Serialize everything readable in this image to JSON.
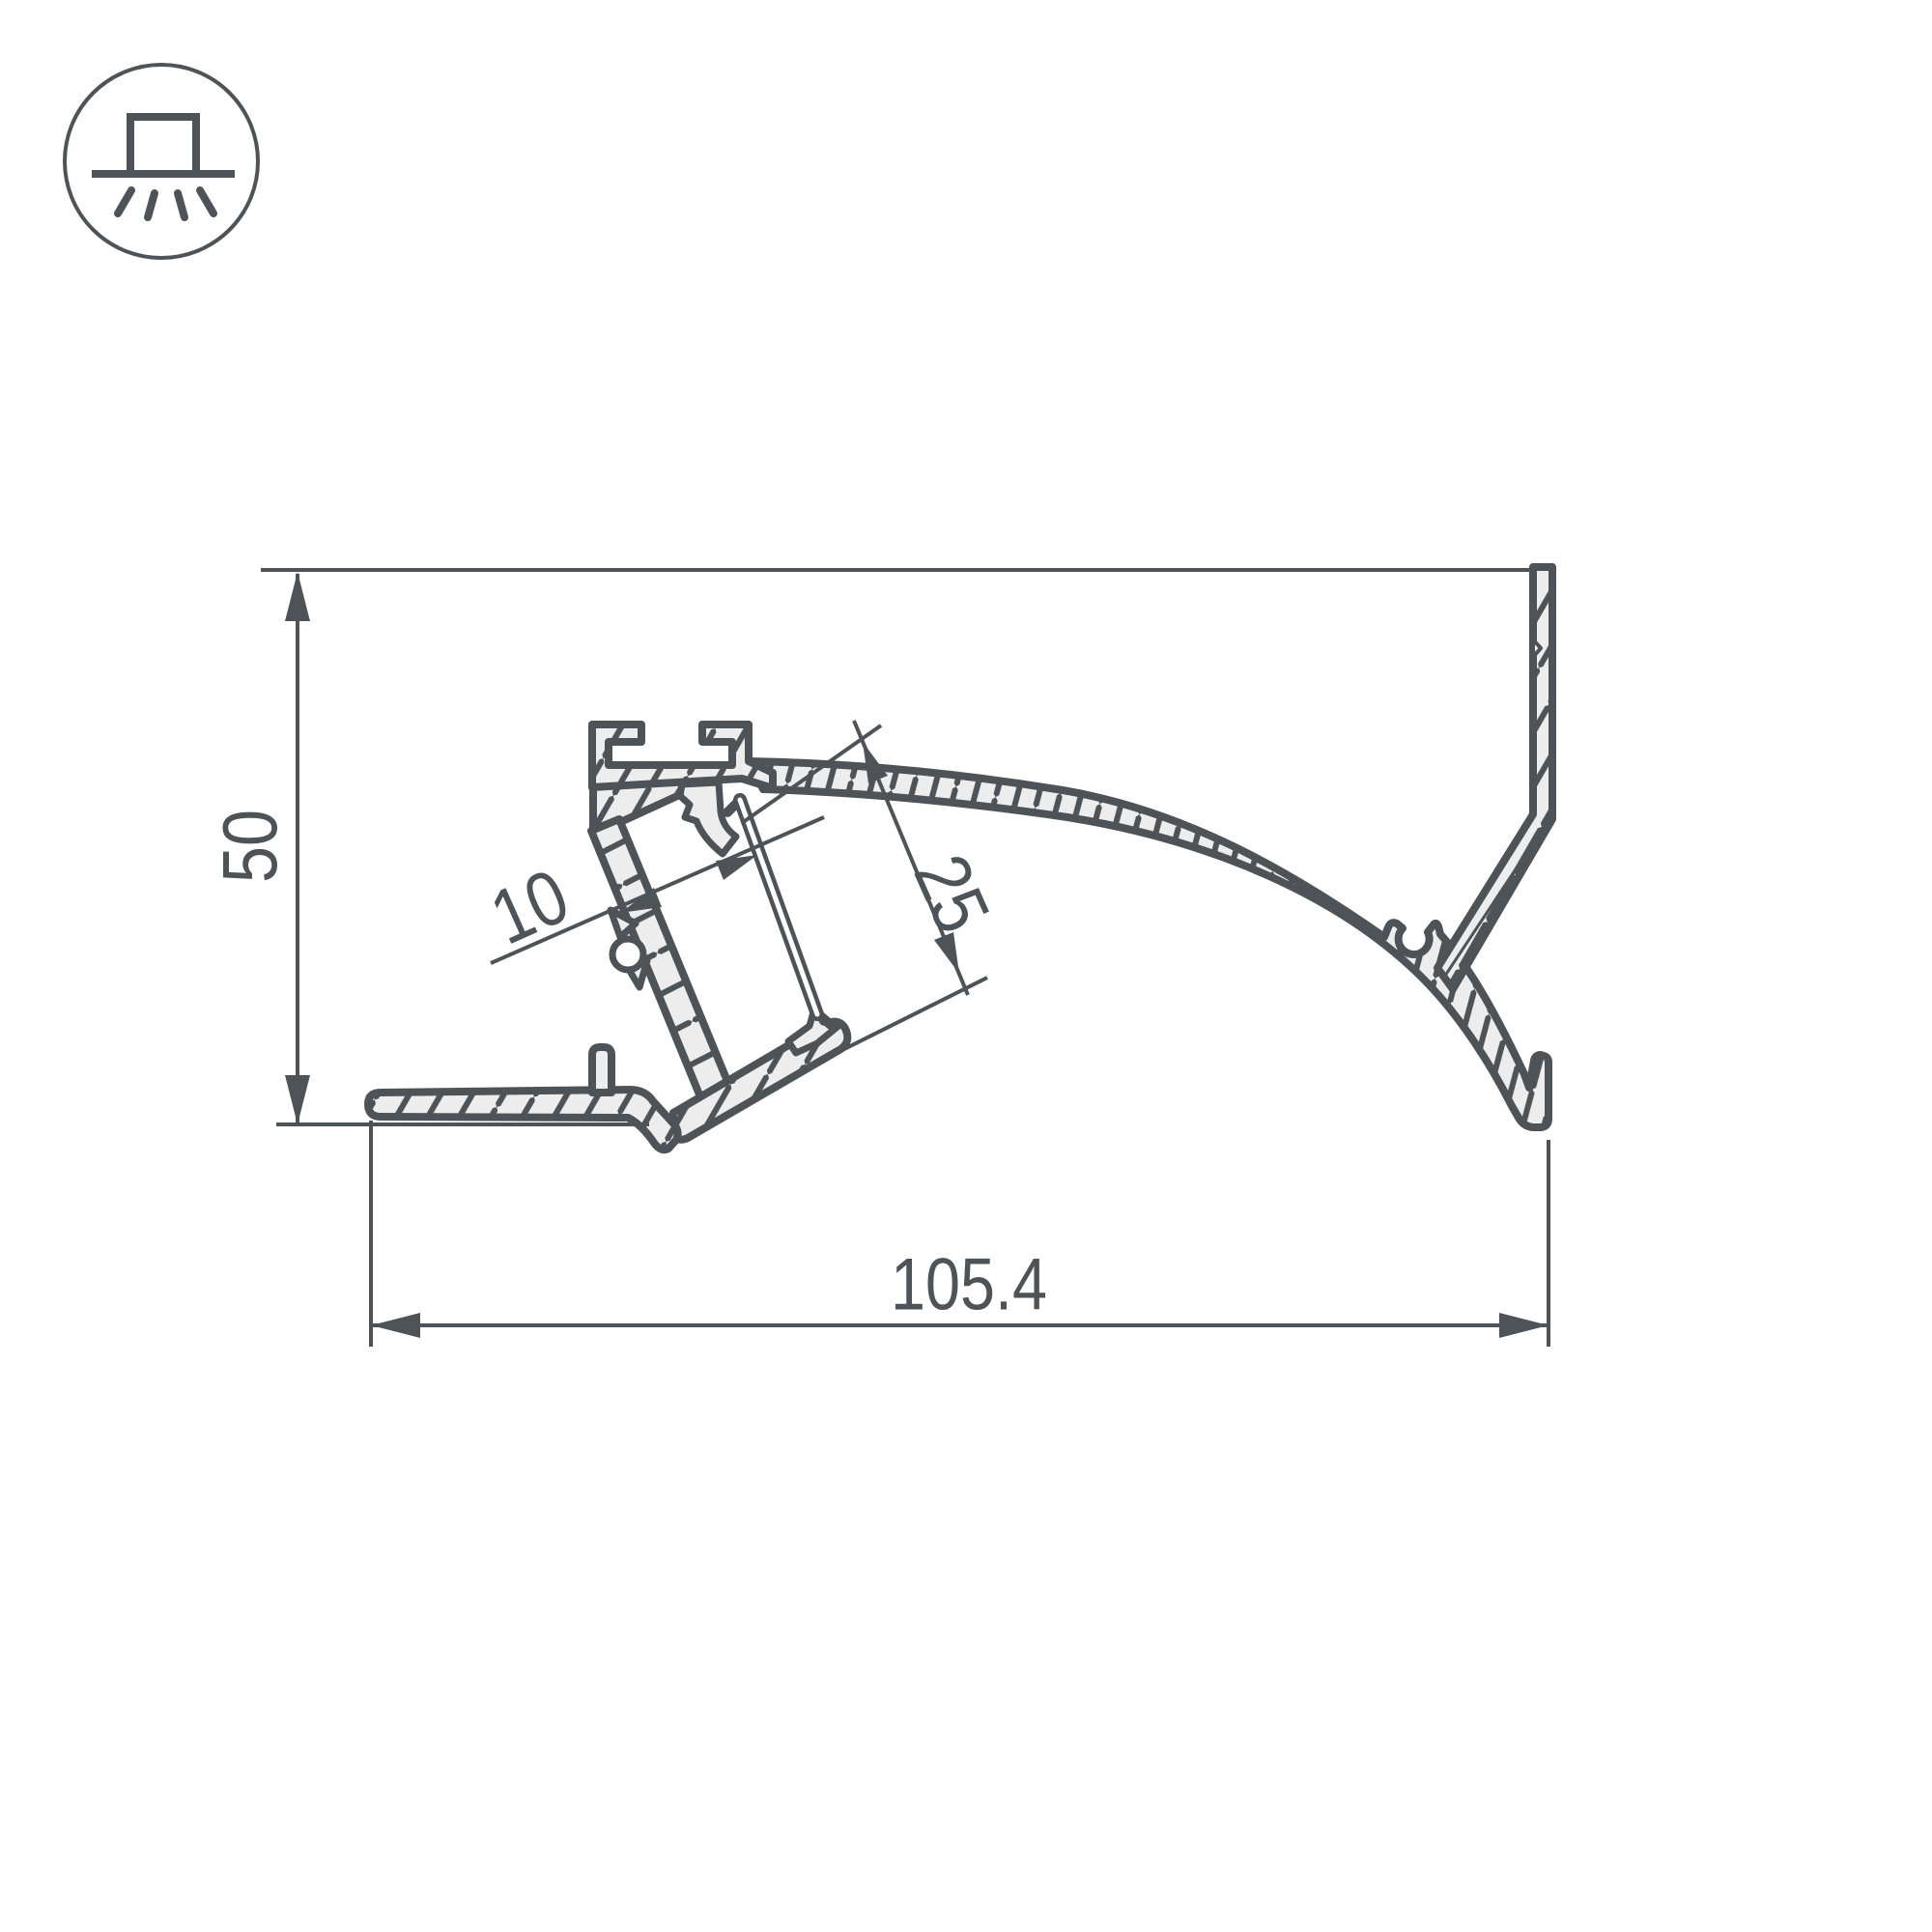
{
  "page": {
    "background": "#ffffff"
  },
  "icon": {
    "name": "surface-mount-downlight",
    "shape": "circle-outline"
  },
  "drawing": {
    "type": "technical-profile-cross-section",
    "ink_color": "#4d5356",
    "fill_color": "#ededee",
    "dimensions": {
      "overall_height": "50",
      "overall_width": "105.4",
      "led_channel_width": "10",
      "led_channel_depth": "25"
    }
  }
}
